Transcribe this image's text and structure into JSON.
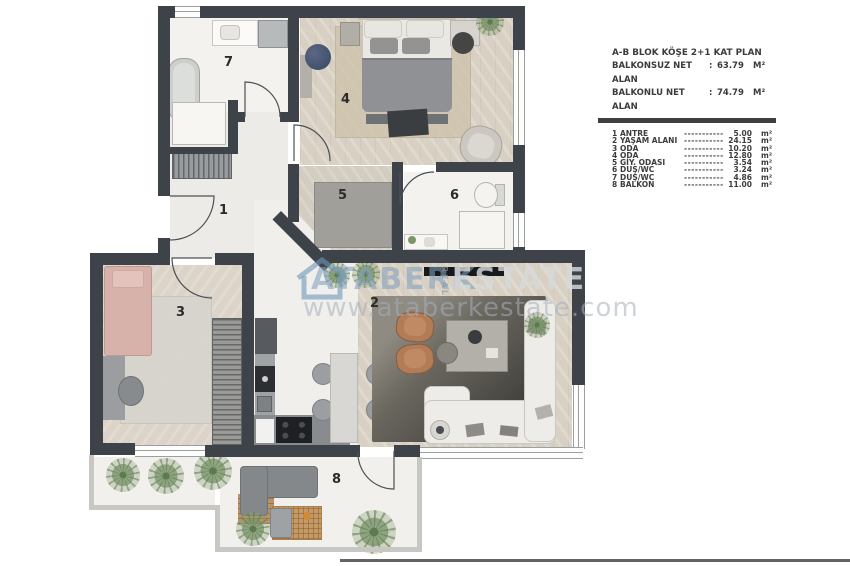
{
  "legend": {
    "title": "A-B BLOK KÖŞE 2+1 KAT PLAN",
    "subtitle1": {
      "label": "BALKONSUZ NET ALAN",
      "colon": ":",
      "value": "63.79",
      "unit": "M²"
    },
    "subtitle2": {
      "label": "BALKONLU NET ALAN",
      "colon": ":",
      "value": "74.79",
      "unit": "M²"
    },
    "rows": [
      {
        "no": "1",
        "name": "ANTRE",
        "dots": "-----------",
        "value": "5.00",
        "unit": "m²"
      },
      {
        "no": "2",
        "name": "YAŞAM ALANI",
        "dots": "-----------",
        "value": "24.15",
        "unit": "m²"
      },
      {
        "no": "3",
        "name": "ODA",
        "dots": "-----------",
        "value": "10.20",
        "unit": "m²"
      },
      {
        "no": "4",
        "name": "ODA",
        "dots": "-----------",
        "value": "12.80",
        "unit": "m²"
      },
      {
        "no": "5",
        "name": "GİY. ODASI",
        "dots": "-----------",
        "value": "3.54",
        "unit": "m²"
      },
      {
        "no": "6",
        "name": "DUŞ/WC",
        "dots": "-----------",
        "value": "3.24",
        "unit": "m²"
      },
      {
        "no": "7",
        "name": "DUŞ/WC",
        "dots": "-----------",
        "value": "4.86",
        "unit": "m²"
      },
      {
        "no": "8",
        "name": "BALKON",
        "dots": "-----------",
        "value": "11.00",
        "unit": "m²"
      }
    ]
  },
  "watermark": {
    "brand_first": "ATABERK",
    "brand_mid": "REAL",
    "brand_last": "ESTATE",
    "website": "www.ataberkestate.com"
  },
  "plan": {
    "room_numbers": [
      "1",
      "2",
      "3",
      "4",
      "5",
      "6",
      "7",
      "8"
    ]
  },
  "colors": {
    "wall": "#3e434a",
    "watermark_blue": "#82a0be",
    "legend_text": "#3b3b3b"
  }
}
